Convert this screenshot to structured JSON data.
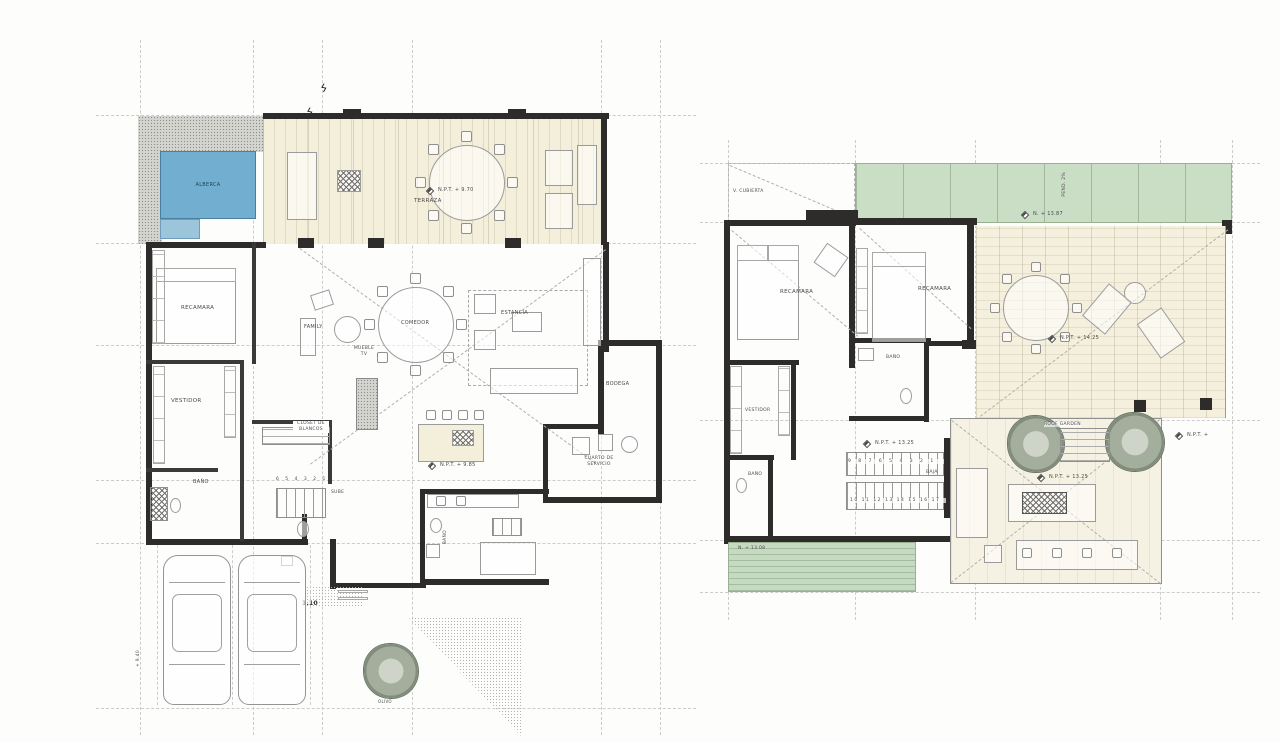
{
  "colors": {
    "pool": "#72aecf",
    "pool_step": "#9cc4da",
    "deck_cream": "#f4efdb",
    "roof_green": "#caddc5",
    "wall": "#2d2c2a"
  },
  "plan_ground": {
    "labels": {
      "alberca": "ALBERCA",
      "terraza": "TERRAZA",
      "terraza_level": "N.P.T. + 9.70",
      "recamara": "RECAMARA",
      "family": "FAMILY",
      "comedor": "COMEDOR",
      "mueble_tv": "MUEBLE TV",
      "estancia": "ESTANCIA",
      "vestidor": "VESTIDOR",
      "closet_blancos": "CLOSET DE BLANCOS",
      "bano_vestidor": "BAÑO",
      "bano_servicio": "BAÑO",
      "sube": "SUBE",
      "stair_numbers": "6 5 4 3 2 1",
      "kitchen_level": "N.P.T. + 9.85",
      "bodega": "BODEGA",
      "cuarto_servicio": "CUARTO DE SERVICIO",
      "dim_entry": "1.10",
      "level_940": "+ 9.40",
      "olivo": "OLIVO"
    }
  },
  "plan_upper": {
    "labels": {
      "v_cubierta": "V. CUBIERTA",
      "pendiente": "PEND. 2%",
      "roof_level": "N. + 13.87",
      "recamara_1": "RECAMARA",
      "recamara_2": "RECAMARA",
      "terrace_level": "N.P.T. + 14.25",
      "vestidor": "VESTIDOR",
      "bano_1": "BAÑO",
      "bano_2": "BAÑO",
      "hall_level": "N.P.T. + 13.25",
      "stairs_row1": "9 8 7 6 5 4 3 2 1",
      "stairs_row2": "10 11 12 13 14 15 16 17",
      "baja": "BAJA",
      "roof_garden": "ROOF GARDEN",
      "garden_level": "N.P.T. + 13.25",
      "lower_roof_level": "N. + 13.08",
      "edge_level": "N.P.T. +"
    }
  }
}
